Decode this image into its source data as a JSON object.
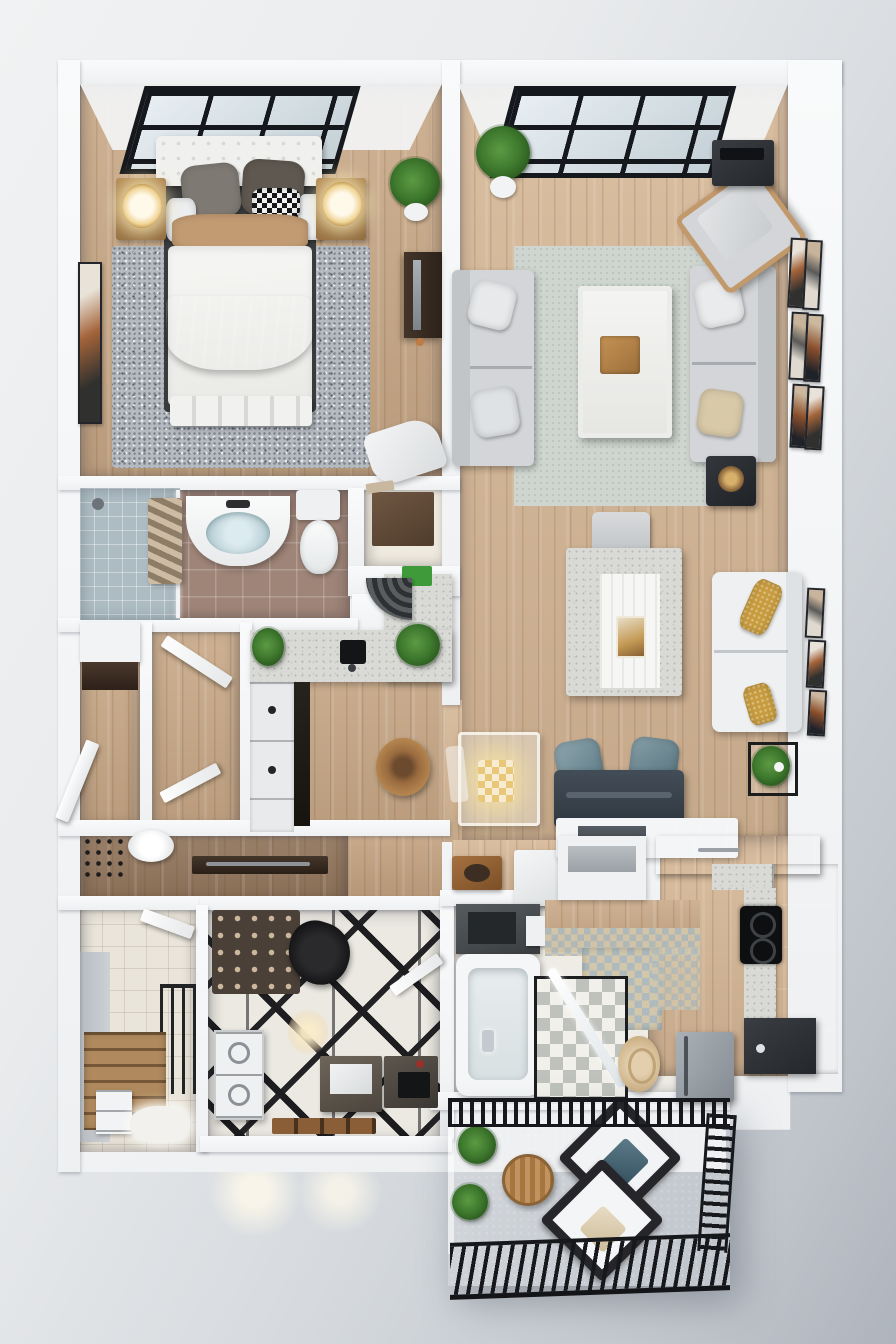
{
  "meta": {
    "image_type": "3d-floor-plan-render",
    "view": "top-down isometric",
    "description": "Photorealistic 3D rendering of a modern apartment floor plan with bedroom, living room, two bathrooms, kitchenette, main kitchen, laundry room, entry stairs and balcony",
    "visible_text": "none"
  },
  "palette": {
    "background_gray": "#d6dade",
    "wall_white": "#f6f7f9",
    "wood_floor": "#c9a987",
    "wood_floor_light": "#d6b796",
    "wood_floor_deep": "#93765c",
    "rug_gray": "#b4bac0",
    "rug_sage": "#cfd6d0",
    "sofa_gray": "#d3d5d8",
    "sofa_white": "#eef0f1",
    "bench_navy": "#39424d",
    "pillow_teal": "#6e8b96",
    "pillow_mustard": "#c79b3e",
    "cabinet_charcoal": "#26292d",
    "counter_speckle": "#d9dad6",
    "tile_brown": "#9f8578",
    "tile_blue_gray": "#adbcc3",
    "skylight_frame": "#15181c",
    "glass_blue": "#c3d0d6",
    "lamp_glow": "#efd496",
    "plant_green": "#3f7a2e",
    "balcony_floor": "#a2a9ae",
    "railing_black": "#17181b",
    "throw_brown": "#8d7a6a",
    "geo_floor_black": "#1d1d1f",
    "pouf_beige": "#d9c29e"
  },
  "rooms": {
    "bedroom": {
      "label": "Bedroom",
      "floor": "wood",
      "features": [
        "skylight",
        "double bed",
        "two nightstands with lamps",
        "gray speckled rug",
        "TV console",
        "wall art",
        "potted plant",
        "lounge chair"
      ]
    },
    "living": {
      "label": "Living room",
      "floor": "wood",
      "features": [
        "skylight",
        "two gray sofas",
        "white coffee table with wood tray",
        "accent armchair",
        "audio unit",
        "sage rug",
        "gallery wall of 6 frames",
        "potted plant",
        "side table"
      ]
    },
    "study": {
      "label": "Study / second seating",
      "floor": "wood",
      "features": [
        "white desk with chair",
        "white sofa with mustard pillows",
        "navy daybed with teal pillows",
        "glass dining table with gold pendant",
        "wicker stool",
        "plant stand",
        "3 wall frames",
        "white cube stool"
      ]
    },
    "bathroom1": {
      "label": "Bathroom",
      "floor": "brown tile",
      "features": [
        "glass shower with striped curtain",
        "white vanity with oval basin",
        "toilet"
      ]
    },
    "closet": {
      "label": "Closet",
      "floor": "white",
      "features": [
        "dark floor mat"
      ]
    },
    "kitchenette": {
      "label": "Kitchenette",
      "floor": "wood",
      "features": [
        "L-shaped speckled counter",
        "black sink",
        "two herb plants",
        "white drawer fronts",
        "curved tiled bench",
        "green pad"
      ]
    },
    "hallway": {
      "label": "Hallway",
      "floor": "wood",
      "features": [
        "two swinging doors"
      ]
    },
    "powder": {
      "label": "Powder room",
      "floor": "dark wood",
      "features": [
        "toilet",
        "wall shelf",
        "dark counter"
      ]
    },
    "entry": {
      "label": "Entry with stairs",
      "floor": "cream tile",
      "features": [
        "black stair railing",
        "wood treads",
        "white drawers",
        "fluffy rug",
        "door"
      ]
    },
    "laundry": {
      "label": "Laundry / utility room",
      "floor": "black-white geometric",
      "features": [
        "washer-dryer stack",
        "patterned rug",
        "black chair",
        "vanity with mirror",
        "dark counter with mat",
        "wood shelf",
        "warm ceiling light"
      ]
    },
    "bathroom2": {
      "label": "Second bathroom",
      "floor": "white + checker",
      "features": [
        "bathtub",
        "checkered shower with glass door",
        "dark vanity",
        "mosaic tile",
        "beige pouf"
      ]
    },
    "kitchen": {
      "label": "Main kitchen",
      "floor": "light wood + mosaic",
      "features": [
        "charcoal upper cabinets",
        "charcoal cabinet run",
        "speckled counters",
        "black cooktop with two burners",
        "gray refrigerator",
        "white peninsula with dark drawers"
      ]
    },
    "balcony": {
      "label": "Balcony",
      "floor": "gray concrete",
      "features": [
        "black metal railing on three sides",
        "two white lounge chairs at 45 degrees",
        "round wood table",
        "two grass plants"
      ]
    }
  },
  "furniture_colors": {
    "bed_duvet": "#f4f4f2",
    "bed_throw": "#8d7a6a",
    "bed_tan_band": "#c29b72",
    "headboard": "#f0f0ee",
    "nightstand_wood": "#a97f52",
    "coffee_table": "#f2f2f1",
    "tray_wood": "#b98c53",
    "armchair": "#d3d5d8",
    "desk_top": "#f6f6f4",
    "tub_white": "#f4f6f7",
    "fridge_gray": "#99a0a7",
    "cooktop_black": "#0e0f10",
    "stair_tread": "#b08a5e",
    "balcony_chair_frame": "#26262a",
    "balcony_table": "#b98a5c"
  }
}
